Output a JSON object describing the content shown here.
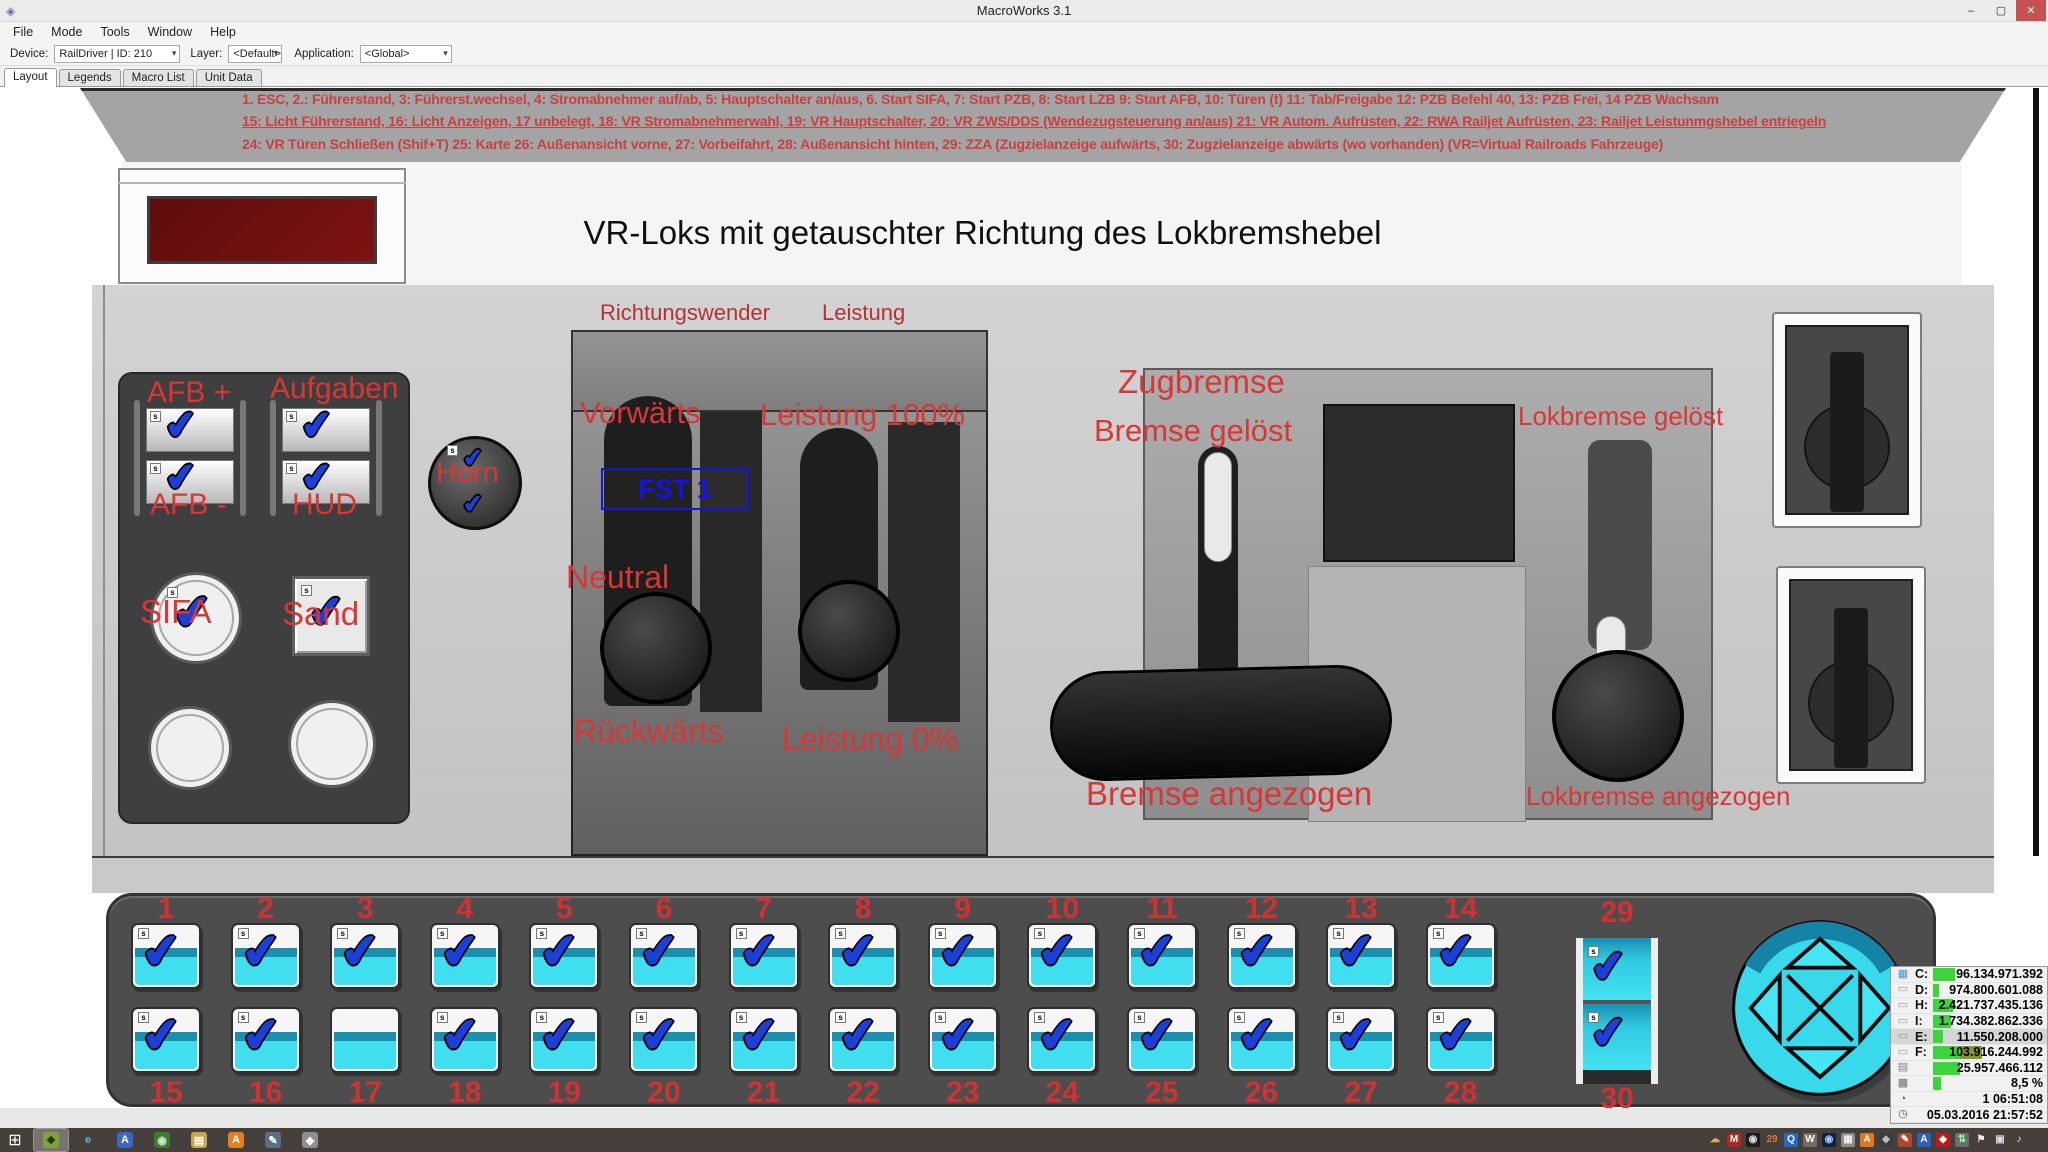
{
  "window": {
    "title": "MacroWorks 3.1",
    "icon": "◈",
    "minimize": "–",
    "maximize": "▢",
    "close": "✕"
  },
  "menu": [
    {
      "label": "File"
    },
    {
      "label": "Mode"
    },
    {
      "label": "Tools"
    },
    {
      "label": "Window"
    },
    {
      "label": "Help"
    }
  ],
  "toolbar": {
    "device_label": "Device:",
    "device_value": "RailDriver | ID: 210",
    "layer_label": "Layer:",
    "layer_value": "<Default>",
    "application_label": "Application:",
    "application_value": "<Global>",
    "dropdown_arrow": "▾"
  },
  "tabs": [
    {
      "label": "Layout",
      "active": true
    },
    {
      "label": "Legends"
    },
    {
      "label": "Macro List"
    },
    {
      "label": "Unit Data"
    }
  ],
  "annotations": {
    "line1": "1. ESC, 2.: Führerstand, 3: Führerst.wechsel, 4: Stromabnehmer auf/ab, 5: Hauptschalter an/aus, 6. Start SIFA, 7: Start PZB, 8: Start LZB 9: Start AFB, 10: Türen (t) 11: Tab/Freigabe 12: PZB Befehl 40, 13: PZB Frei, 14 PZB Wachsam",
    "line2": "15: Licht Führerstand, 16: Licht Anzeigen, 17 unbelegt, 18: VR Stromabnehmerwahl, 19: VR Hauptschalter, 20: VR ZWS/DDS (Wendezugsteuerung an/aus) 21: VR Autom. Aufrüsten, 22: RWA Railjet Aufrüsten, 23: Railjet Leistunmgshebel entriegeln",
    "line3": "24: VR Türen Schließen (Shif+T) 25: Karte 26: Außenansicht vorne, 27: Vorbeifahrt, 28: Außenansicht hinten, 29: ZZA (Zugzielanzeige aufwärts, 30: Zugzielanzeige abwärts (wo vorhanden) (VR=Virtual Railroads Fahrzeuge)"
  },
  "board": {
    "title": "VR-Loks mit getauschter Richtung des Lokbremshebel",
    "left": {
      "afb_plus": "AFB +",
      "aufgaben": "Aufgaben",
      "afb_minus": "AFB -",
      "hud": "HUD",
      "horn": "Horn",
      "sifa": "SIFA",
      "sand": "Sand"
    },
    "center": {
      "richtungswender": "Richtungswender",
      "leistung": "Leistung",
      "vorwaerts": "Vorwärts",
      "leistung100": "Leistung 100%",
      "fst": "FST 1",
      "neutral": "Neutral",
      "rueckwaerts": "Rückwärts",
      "leistung0": "Leistung 0%"
    },
    "brake": {
      "zugbremse": "Zugbremse",
      "bremse_geloest": "Bremse gelöst",
      "lokbremse_geloest": "Lokbremse gelöst",
      "bremse_angezogen": "Bremse angezogen",
      "lokbremse_angezogen": "Lokbremse angezogen"
    }
  },
  "icons": {
    "check": "✔",
    "badge": "s"
  },
  "deck": {
    "row1": [
      {
        "n": "1",
        "checked": true
      },
      {
        "n": "2",
        "checked": true
      },
      {
        "n": "3",
        "checked": true
      },
      {
        "n": "4",
        "checked": true
      },
      {
        "n": "5",
        "checked": true
      },
      {
        "n": "6",
        "checked": true
      },
      {
        "n": "7",
        "checked": true
      },
      {
        "n": "8",
        "checked": true
      },
      {
        "n": "9",
        "checked": true
      },
      {
        "n": "10",
        "checked": true
      },
      {
        "n": "11",
        "checked": true
      },
      {
        "n": "12",
        "checked": true
      },
      {
        "n": "13",
        "checked": true
      },
      {
        "n": "14",
        "checked": true
      }
    ],
    "row2": [
      {
        "n": "15",
        "checked": true
      },
      {
        "n": "16",
        "checked": true
      },
      {
        "n": "17",
        "checked": false
      },
      {
        "n": "18",
        "checked": true
      },
      {
        "n": "19",
        "checked": true
      },
      {
        "n": "20",
        "checked": true
      },
      {
        "n": "21",
        "checked": true
      },
      {
        "n": "22",
        "checked": true
      },
      {
        "n": "23",
        "checked": true
      },
      {
        "n": "24",
        "checked": true
      },
      {
        "n": "25",
        "checked": true
      },
      {
        "n": "26",
        "checked": true
      },
      {
        "n": "27",
        "checked": true
      },
      {
        "n": "28",
        "checked": true
      }
    ],
    "n29": "29",
    "n30": "30"
  },
  "monitor": {
    "rows": [
      {
        "icon": "▦",
        "ic": "#4a90d9",
        "label": "C:",
        "value": "96.134.971.392",
        "bar": 22
      },
      {
        "icon": "▭",
        "ic": "#9a9a9a",
        "label": "D:",
        "value": "974.800.601.088",
        "bar": 6
      },
      {
        "icon": "▭",
        "ic": "#9a9a9a",
        "label": "H:",
        "value": "2.421.737.435.136",
        "bar": 20
      },
      {
        "icon": "▭",
        "ic": "#9a9a9a",
        "label": "I:",
        "value": "1.734.382.862.336",
        "bar": 18
      },
      {
        "icon": "▭",
        "ic": "#9a9a9a",
        "label": "E:",
        "value": "11.550.208.000",
        "bar": 10,
        "hl": true
      },
      {
        "icon": "▭",
        "ic": "#9a9a9a",
        "label": "F:",
        "value": "103.916.244.992",
        "bar": 49,
        "split": true
      },
      {
        "icon": "▤",
        "ic": "#808080",
        "label": "",
        "value": "25.957.466.112",
        "bar": 27
      },
      {
        "icon": "▩",
        "ic": "#707070",
        "label": "",
        "value": "8,5 %",
        "bar": 8
      },
      {
        "icon": "◔",
        "ic": "#555555",
        "label": "",
        "value": "1  06:51:08",
        "bar": 0
      },
      {
        "icon": "◷",
        "ic": "#555555",
        "label": "",
        "value": "05.03.2016 21:57:52",
        "bar": 0
      }
    ]
  },
  "taskbar": {
    "start": "⊞",
    "apps": [
      {
        "glyph": "❖",
        "bg": "#7da23f",
        "fg": "#1d3a12",
        "active": true
      },
      {
        "glyph": "e",
        "bg": "transparent",
        "fg": "#5ab4e8"
      },
      {
        "glyph": "A",
        "bg": "#3a66c8",
        "fg": "#ffffff"
      },
      {
        "glyph": "◉",
        "bg": "#3f7a2f",
        "fg": "#cde8cd"
      },
      {
        "glyph": "▤",
        "bg": "#caa54a",
        "fg": "#ffffff"
      },
      {
        "glyph": "A",
        "bg": "#e08020",
        "fg": "#ffffff"
      },
      {
        "glyph": "✎",
        "bg": "#5a6f85",
        "fg": "#ffffff"
      },
      {
        "glyph": "◈",
        "bg": "#8f8f8f",
        "fg": "#ffffff"
      }
    ],
    "tray": [
      {
        "glyph": "☁",
        "bg": "transparent",
        "fg": "#e0b050"
      },
      {
        "glyph": "M",
        "bg": "#b52420",
        "fg": "#ffffff"
      },
      {
        "glyph": "◉",
        "bg": "#1c1c1c",
        "fg": "#dddddd"
      },
      {
        "glyph": "29",
        "bg": "transparent",
        "fg": "#e07838"
      },
      {
        "glyph": "Q",
        "bg": "#2468c4",
        "fg": "#ffffff"
      },
      {
        "glyph": "W",
        "bg": "#776b5e",
        "fg": "#ffffff"
      },
      {
        "glyph": "◉",
        "bg": "#16213c",
        "fg": "#99ccff"
      },
      {
        "glyph": "▦",
        "bg": "#8c8c8c",
        "fg": "#eeeeee"
      },
      {
        "glyph": "A",
        "bg": "#e07818",
        "fg": "#ffffff"
      },
      {
        "glyph": "◆",
        "bg": "#3c3c3c",
        "fg": "#bbbbbb"
      },
      {
        "glyph": "✎",
        "bg": "#b5452a",
        "fg": "#ffffff"
      },
      {
        "glyph": "A",
        "bg": "#2b5fc0",
        "fg": "#ffffff"
      },
      {
        "glyph": "◆",
        "bg": "#c01818",
        "fg": "#ffffff"
      },
      {
        "glyph": "⇅",
        "bg": "#6d6d6d",
        "fg": "#99ff99"
      },
      {
        "glyph": "⚑",
        "bg": "transparent",
        "fg": "#eeeeee"
      },
      {
        "glyph": "▣",
        "bg": "transparent",
        "fg": "#dddddd"
      },
      {
        "glyph": "♪",
        "bg": "transparent",
        "fg": "#eeeeee"
      }
    ]
  }
}
